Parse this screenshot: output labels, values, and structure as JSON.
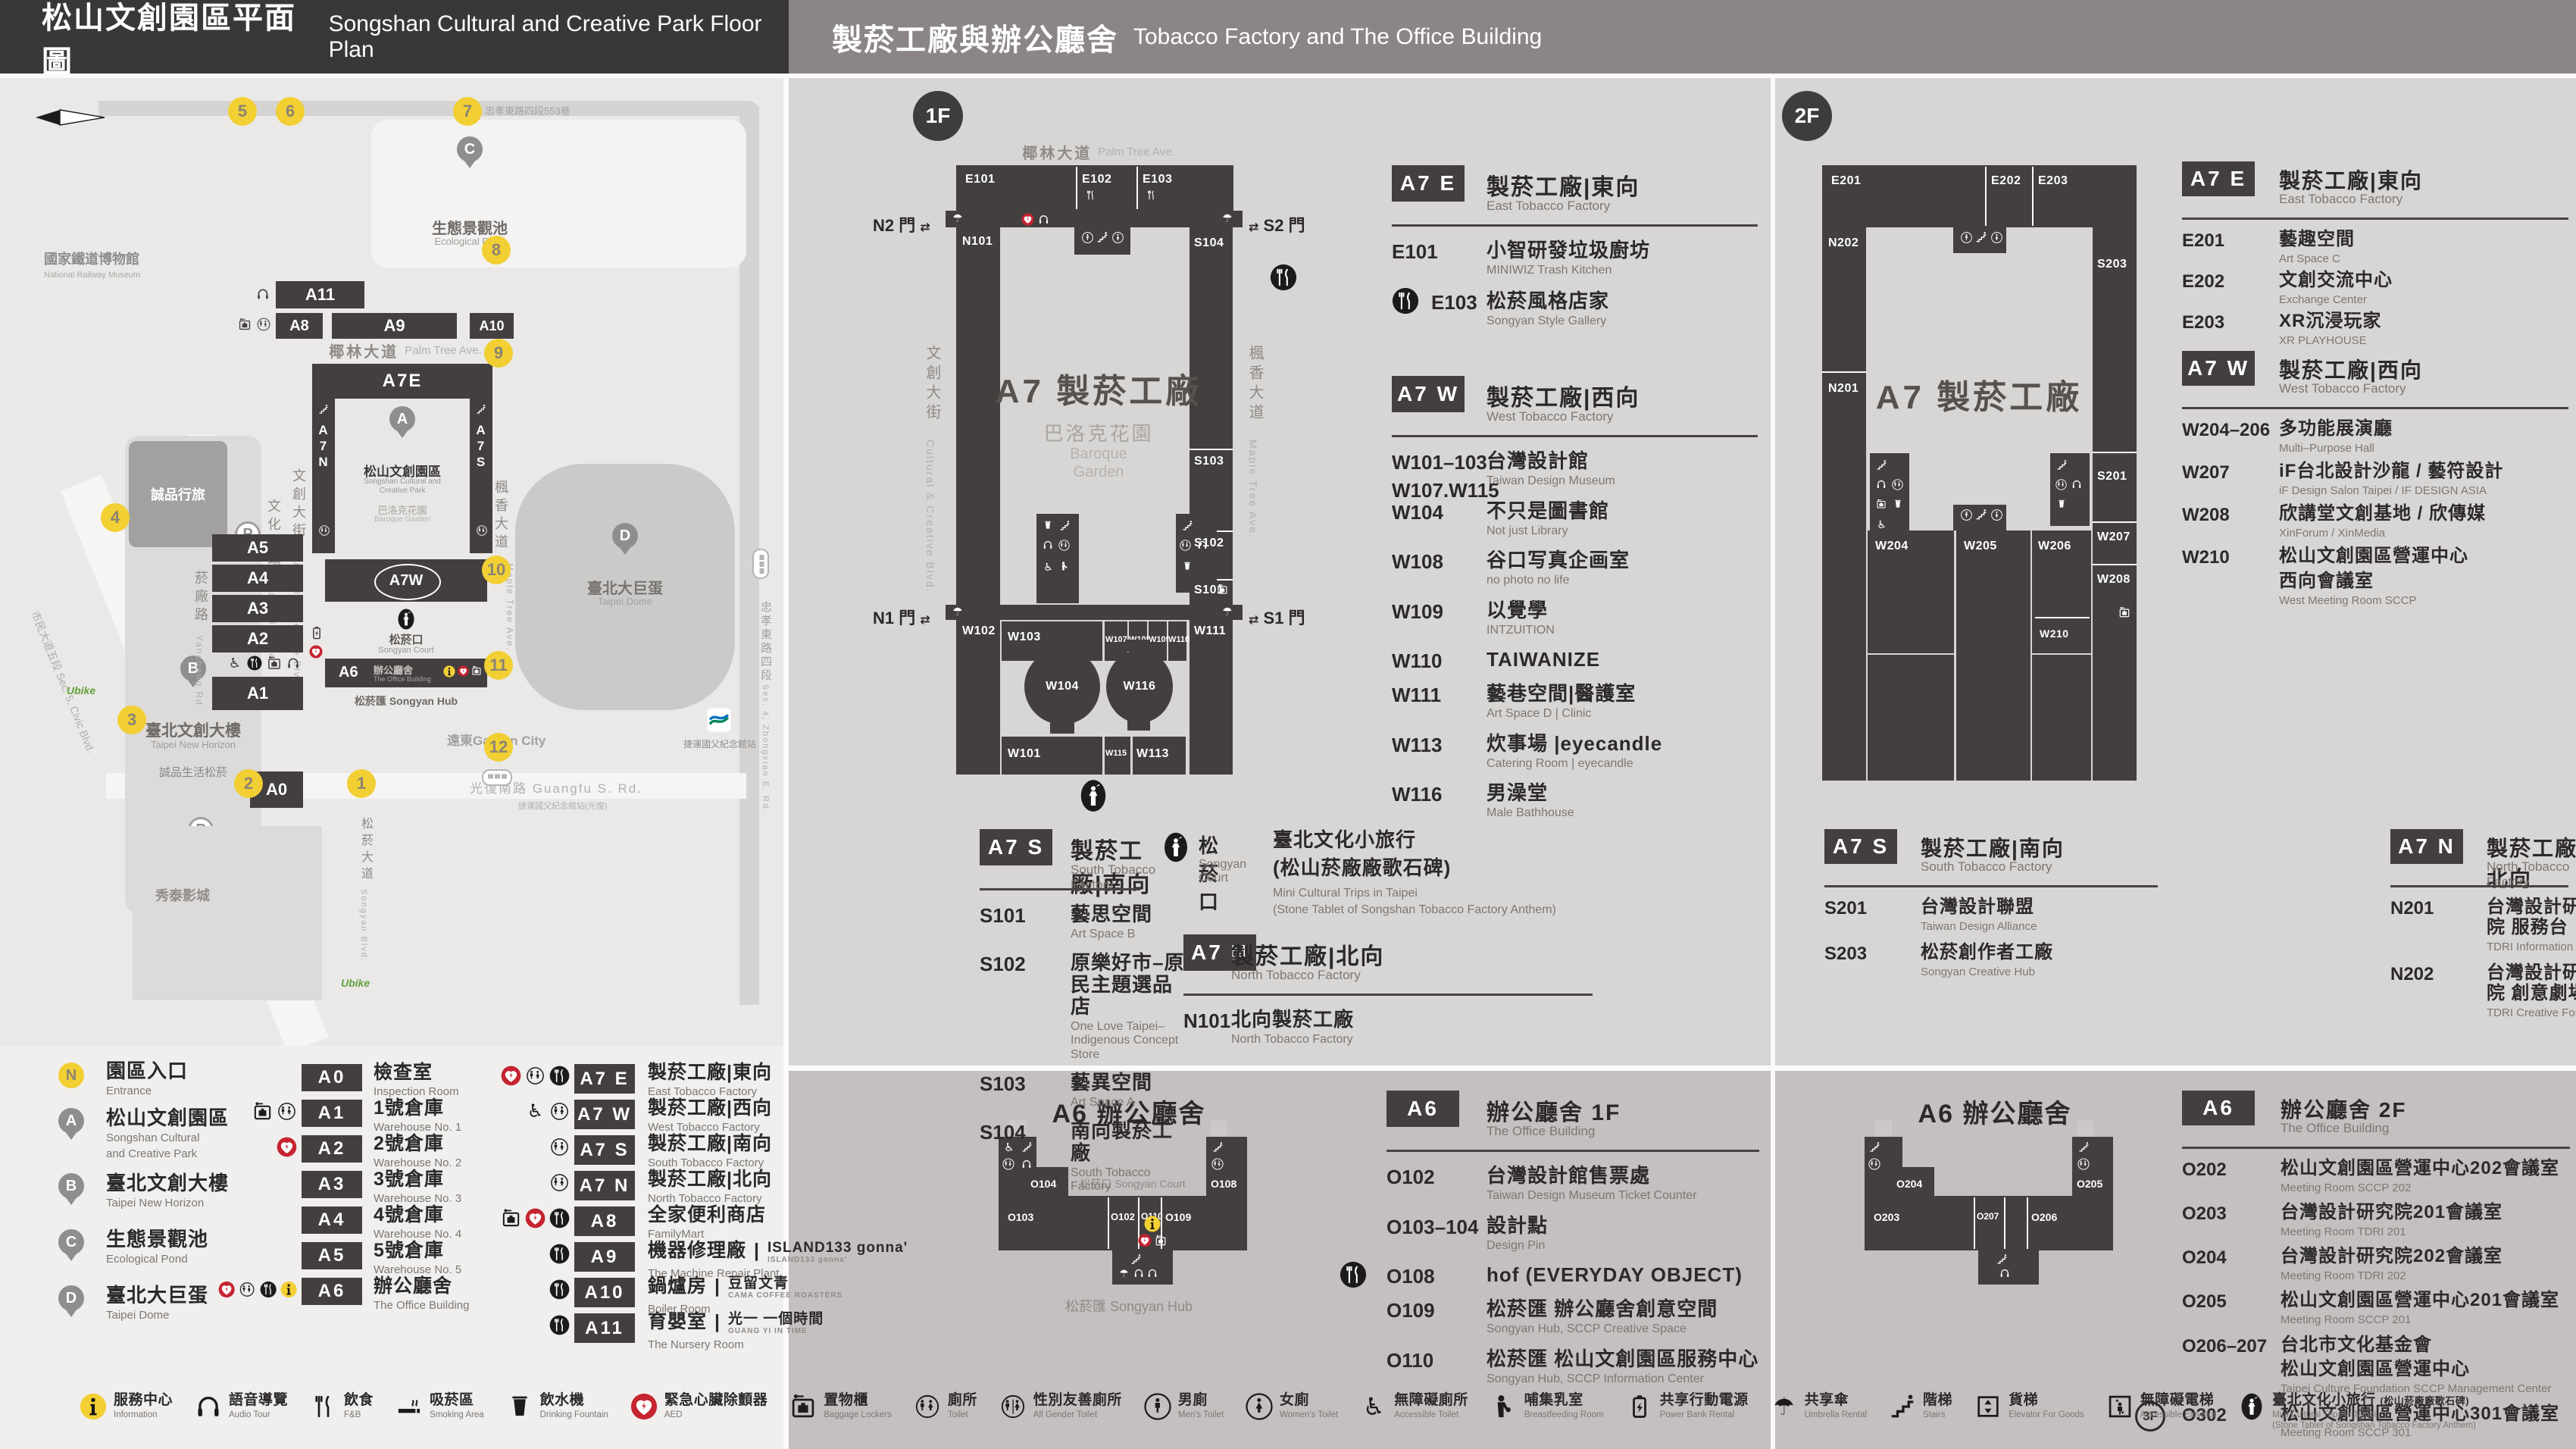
{
  "colors": {
    "accent_yellow": "#f2cf33",
    "aed_red": "#c52430",
    "dark_building": "#433f3f"
  },
  "header": {
    "left_zh": "松山文創園區平面圖",
    "left_en": "Songshan Cultural and Creative Park Floor Plan",
    "right_zh": "製菸工廠與辦公廳舍",
    "right_en": "Tobacco Factory and The Office Building"
  },
  "map": {
    "road_top": "忠孝東路四段553巷",
    "railway_zh": "國家鐵道博物館",
    "railway_en": "National Railway Museum",
    "pond_zh": "生態景觀池",
    "pond_en": "Ecological Pond",
    "palm_zh": "椰林大道",
    "palm_en": "Palm Tree Ave.",
    "eslite_hotel": "誠品行旅",
    "b_zh": "臺北文創大樓",
    "b_en": "Taipei New Horizon",
    "eslite_songyan": "誠品生活松菸",
    "plaza_zh": "文化廣場",
    "plaza_en": "Cultural Plaza",
    "blvd_zh": "文創大街",
    "blvd_en": "Cultural & Creative Blvd.",
    "maple_zh": "楓香大道",
    "maple_en": "Maple Tree Ave.",
    "yanchang_zh": "菸廠路",
    "yanchang_en": "Yanchang Rd.",
    "civic": "市民大道五段 Sec. 5, Civic Blvd.",
    "songyan_ave_zh": "松菸大道",
    "songyan_ave_en": "Songyan Blvd.",
    "zhongxiao_zh": "忠孝東路四段",
    "zhongxiao_en": "Sec. 4, Zhongxiao E. Rd.",
    "guangfu": "光復南路 Guangfu S. Rd.",
    "a7e": "A7E",
    "a7n": "A7N",
    "a7s": "A7S",
    "a7w": "A7W",
    "a6": "A6",
    "park_zh": "松山文創園區",
    "park_en1": "Songshan Cultural and",
    "park_en2": "Creative Park",
    "garden_zh": "巴洛克花園",
    "garden_en": "Baroque Garden",
    "court_zh": "松菸口",
    "court_en": "Songyan Court",
    "office_zh": "辦公廳舍",
    "office_en": "The Office Building",
    "hub": "松菸匯 Songyan Hub",
    "bars": {
      "a11": "A11",
      "a8": "A8",
      "a9": "A9",
      "a10": "A10",
      "a5": "A5",
      "a4": "A4",
      "a3": "A3",
      "a2": "A2",
      "a1": "A1",
      "a0": "A0"
    },
    "dome_zh": "臺北大巨蛋",
    "dome_en": "Taipei Dome",
    "gardencity": "遠東Garden City",
    "showtime": "秀泰影城",
    "mrt": "捷運國父紀念館站",
    "mrt_bus": "捷運國父紀念館站(光復)",
    "ubike": "Ubike",
    "pins": {
      "a": "A",
      "b": "B",
      "c": "C",
      "d": "D"
    },
    "markers": [
      "1",
      "2",
      "3",
      "4",
      "5",
      "6",
      "7",
      "8",
      "9",
      "10",
      "11",
      "12"
    ]
  },
  "plan1f": {
    "badge": "1F",
    "street_top_zh": "椰林大道",
    "street_top_en": "Palm Tree Ave.",
    "street_left_zh": "文創大街",
    "street_left_en": "Cultural & Creative Blvd.",
    "street_right_zh": "楓香大道",
    "street_right_en": "Maple Tree Ave.",
    "center": "A7 製菸工廠",
    "garden_zh": "巴洛克花園",
    "garden_en1": "Baroque",
    "garden_en2": "Garden",
    "gate_n2": "N2 門",
    "gate_s2": "S2 門",
    "gate_n1": "N1 門",
    "gate_s1": "S1 門",
    "rooms": {
      "e101": "E101",
      "e102": "E102",
      "e103": "E103",
      "n101": "N101",
      "w102": "W102",
      "s104": "S104",
      "s103": "S103",
      "s102": "S102",
      "s101": "S101",
      "w111": "W111",
      "w103": "W103",
      "w107": "W107",
      "w108": "W108",
      "w109": "W109",
      "w110": "W110",
      "w104": "W104",
      "w116": "W116",
      "w101": "W101",
      "w115": "W115",
      "w113": "W113"
    }
  },
  "plan2f": {
    "badge": "2F",
    "center": "A7 製菸工廠",
    "rooms": {
      "e201": "E201",
      "e202": "E202",
      "e203": "E203",
      "n202": "N202",
      "n201": "N201",
      "s203": "S203",
      "s201": "S201",
      "w204": "W204",
      "w205": "W205",
      "w206": "W206",
      "w207": "W207",
      "w208": "W208",
      "w210": "W210"
    }
  },
  "a6plan1f": {
    "title": "A6 辦公廳舍",
    "court": "松菸口 Songyan Court",
    "hub": "松菸匯 Songyan Hub",
    "rooms": {
      "o104": "O104",
      "o103": "O103",
      "o102": "O102",
      "o110": "O110",
      "o109": "O109",
      "o108": "O108"
    }
  },
  "a6plan2f": {
    "title": "A6 辦公廳舍",
    "rooms": {
      "o204": "O204",
      "o203": "O203",
      "o207": "O207",
      "o206": "O206",
      "o205": "O205"
    }
  },
  "lists": {
    "f1_e": {
      "badge": "A7 E",
      "zh": "製菸工廠|東向",
      "en": "East Tobacco Factory",
      "rows": [
        {
          "code": "E101",
          "zh": "小智研發垃圾廚坊",
          "en": "MINIWIZ Trash Kitchen"
        },
        {
          "icon": "fnb",
          "code": "E103",
          "zh": "松菸風格店家",
          "en": "Songyan Style Gallery"
        }
      ]
    },
    "f1_w": {
      "badge": "A7 W",
      "zh": "製菸工廠|西向",
      "en": "West Tobacco Factory",
      "rows": [
        {
          "code": "W101–103",
          "code2": "W107.W115",
          "zh": "台灣設計館",
          "en": "Taiwan Design Museum"
        },
        {
          "code": "W104",
          "zh": "不只是圖書館",
          "en": "Not just Library"
        },
        {
          "code": "W108",
          "zh": "谷口写真企画室",
          "en": "no photo no life"
        },
        {
          "code": "W109",
          "zh": "以覺學",
          "en": "INTZUITION"
        },
        {
          "code": "W110",
          "zh": "TAIWANIZE"
        },
        {
          "code": "W111",
          "zh": "藝巷空間|醫護室",
          "en": "Art Space D | Clinic"
        },
        {
          "code": "W113",
          "zh": "炊事場 |eyecandle",
          "en": "Catering Room | eyecandle"
        },
        {
          "code": "W116",
          "zh": "男澡堂",
          "en": "Male Bathhouse"
        }
      ]
    },
    "f1_s": {
      "badge": "A7 S",
      "zh": "製菸工廠|南向",
      "en": "South Tobacco Factory",
      "rows": [
        {
          "code": "S101",
          "zh": "藝思空間",
          "en": "Art Space B"
        },
        {
          "code": "S102",
          "zh": "原樂好市–原民主題選品店",
          "en": "One Love Taipei–Indigenous Concept Store"
        },
        {
          "code": "S103",
          "zh": "藝異空間",
          "en": "Art Space A"
        },
        {
          "code": "S104",
          "zh": "南向製菸工廠",
          "en": "South Tobacco Factory"
        }
      ]
    },
    "f1_n": {
      "badge": "A7 N",
      "zh": "製菸工廠|北向",
      "en": "North Tobacco Factory",
      "rows": [
        {
          "code": "N101",
          "zh": "北向製菸工廠",
          "en": "North Tobacco Factory"
        }
      ]
    },
    "f2_e": {
      "badge": "A7 E",
      "zh": "製菸工廠|東向",
      "en": "East Tobacco Factory",
      "rows": [
        {
          "code": "E201",
          "zh": "藝趣空間",
          "en": "Art Space C"
        },
        {
          "code": "E202",
          "zh": "文創交流中心",
          "en": "Exchange Center"
        },
        {
          "code": "E203",
          "zh": "XR沉浸玩家",
          "en": "XR PLAYHOUSE"
        }
      ]
    },
    "f2_w": {
      "badge": "A7 W",
      "zh": "製菸工廠|西向",
      "en": "West Tobacco Factory",
      "rows": [
        {
          "code": "W204–206",
          "zh": "多功能展演廳",
          "en": "Multi–Purpose Hall"
        },
        {
          "code": "W207",
          "zh": "iF台北設計沙龍 / 藝符設計",
          "en": "iF Design Salon Taipei / IF DESIGN ASIA"
        },
        {
          "code": "W208",
          "zh": "欣講堂文創基地 / 欣傳媒",
          "en": "XinForum / XinMedia"
        },
        {
          "code": "W210",
          "zh": "松山文創園區營運中心",
          "zh2": "西向會議室",
          "en": "West Meeting Room SCCP"
        }
      ]
    },
    "f2_s": {
      "badge": "A7 S",
      "zh": "製菸工廠|南向",
      "en": "South Tobacco Factory",
      "rows": [
        {
          "code": "S201",
          "zh": "台灣設計聯盟",
          "en": "Taiwan Design Alliance"
        },
        {
          "code": "S203",
          "zh": "松菸創作者工廠",
          "en": "Songyan Creative Hub"
        }
      ]
    },
    "f2_n": {
      "badge": "A7 N",
      "zh": "製菸工廠|北向",
      "en": "North Tobacco Factory",
      "rows": [
        {
          "code": "N201",
          "zh": "台灣設計研究院 服務台",
          "en": "TDRI Information"
        },
        {
          "code": "N202",
          "zh": "台灣設計研究院 創意劇場",
          "en": "TDRI Creative Forum"
        }
      ]
    },
    "a6_1f": {
      "badge": "A6",
      "zh": "辦公廳舍 1F",
      "en": "The Office Building",
      "rows": [
        {
          "code": "O102",
          "zh": "台灣設計館售票處",
          "en": "Taiwan Design Museum Ticket Counter"
        },
        {
          "code": "O103–104",
          "zh": "設計點",
          "en": "Design Pin"
        },
        {
          "icon": "fnb",
          "code": "O108",
          "zh": "hof (EVERYDAY OBJECT)"
        },
        {
          "code": "O109",
          "zh": "松菸匯 辦公廳舍創意空間",
          "en": "Songyan Hub, SCCP Creative Space"
        },
        {
          "code": "O110",
          "zh": "松菸匯 松山文創園區服務中心",
          "en": "Songyan Hub, SCCP Information Center"
        }
      ]
    },
    "a6_2f": {
      "badge": "A6",
      "zh": "辦公廳舍 2F",
      "en": "The Office Building",
      "rows": [
        {
          "code": "O202",
          "zh": "松山文創園區營運中心202會議室",
          "en": "Meeting Room SCCP 202"
        },
        {
          "code": "O203",
          "zh": "台灣設計研究院201會議室",
          "en": "Meeting Room TDRI 201"
        },
        {
          "code": "O204",
          "zh": "台灣設計研究院202會議室",
          "en": "Meeting Room TDRI 202"
        },
        {
          "code": "O205",
          "zh": "松山文創園區營運中心201會議室",
          "en": "Meeting Room SCCP 201"
        },
        {
          "code": "O206–207",
          "zh": "台北市文化基金會",
          "zh2": "松山文創園區營運中心",
          "en": "Taipei Culture Foundation SCCP Management Center"
        },
        {
          "icon": "threef",
          "code": "O302",
          "zh": "松山文創園區營運中心301會議室",
          "en": "Meeting Room SCCP 301"
        }
      ]
    }
  },
  "court": {
    "zh": "松菸口",
    "en": "Songyan Court",
    "name_zh1": "臺北文化小旅行",
    "name_zh2": "(松山菸廠廠歌石碑)",
    "name_en1": "Mini Cultural Trips in Taipei",
    "name_en2": "(Stone Tablet of Songshan Tobacco Factory Anthem)"
  },
  "legend_places": [
    {
      "mark": "N",
      "type": "circle",
      "zh": "園區入口",
      "en": [
        "Entrance"
      ]
    },
    {
      "mark": "A",
      "type": "pin",
      "zh": "松山文創園區",
      "en": [
        "Songshan Cultural",
        "and Creative Park"
      ]
    },
    {
      "mark": "B",
      "type": "pin",
      "zh": "臺北文創大樓",
      "en": [
        "Taipei New Horizon"
      ]
    },
    {
      "mark": "C",
      "type": "pin",
      "zh": "生態景觀池",
      "en": [
        "Ecological Pond"
      ]
    },
    {
      "mark": "D",
      "type": "pin",
      "zh": "臺北大巨蛋",
      "en": [
        "Taipei Dome"
      ]
    }
  ],
  "legend_mid": [
    {
      "icons": [],
      "badge": "A0",
      "zh": "檢查室",
      "en": "Inspection Room"
    },
    {
      "icons": [
        "lockers",
        "toilet"
      ],
      "badge": "A1",
      "zh": "1號倉庫",
      "en": "Warehouse No. 1"
    },
    {
      "icons": [
        "aed"
      ],
      "badge": "A2",
      "zh": "2號倉庫",
      "en": "Warehouse No. 2"
    },
    {
      "icons": [],
      "badge": "A3",
      "zh": "3號倉庫",
      "en": "Warehouse No. 3"
    },
    {
      "icons": [],
      "badge": "A4",
      "zh": "4號倉庫",
      "en": "Warehouse No. 4"
    },
    {
      "icons": [],
      "badge": "A5",
      "zh": "5號倉庫",
      "en": "Warehouse No. 5"
    },
    {
      "icons": [
        "aed",
        "toilet",
        "fnb",
        "info"
      ],
      "badge": "A6",
      "zh": "辦公廳舍",
      "en": "The Office Building"
    }
  ],
  "legend_right": [
    {
      "icons": [
        "aed",
        "toilet",
        "fnb"
      ],
      "badge": "A7 E",
      "zh": "製菸工廠|東向",
      "en": "East Tobacco Factory"
    },
    {
      "icons": [
        "accessible",
        "toilet"
      ],
      "badge": "A7 W",
      "zh": "製菸工廠|西向",
      "en": "West Tobacco Factory"
    },
    {
      "icons": [
        "toilet"
      ],
      "badge": "A7 S",
      "zh": "製菸工廠|南向",
      "en": "South Tobacco Factory"
    },
    {
      "icons": [
        "toilet"
      ],
      "badge": "A7 N",
      "zh": "製菸工廠|北向",
      "en": "North Tobacco Factory"
    },
    {
      "icons": [
        "lockers",
        "aed",
        "fnb"
      ],
      "badge": "A8",
      "zh": "全家便利商店",
      "en": "FamilyMart"
    },
    {
      "icons": [
        "fnb"
      ],
      "badge": "A9",
      "zh": "機器修理廠",
      "brand": "ISLAND133 gonna'",
      "brand_en": "ISLAND133 gonna'",
      "en": "The Machine Repair Plant"
    },
    {
      "icons": [
        "fnb"
      ],
      "badge": "A10",
      "zh": "鍋爐房",
      "brand": "豆留文青",
      "brand_en": "CAMA COFFEE ROASTERS",
      "en": "Boiler Room"
    },
    {
      "icons": [
        "fnb"
      ],
      "badge": "A11",
      "zh": "育嬰室",
      "brand": "光一 一個時間",
      "brand_en": "GUANG YI IN TIME",
      "en": "The Nursery Room"
    }
  ],
  "footer": [
    {
      "icon": "info",
      "zh": "服務中心",
      "en": "Information"
    },
    {
      "icon": "audio",
      "zh": "語音導覽",
      "en": "Audio Tour"
    },
    {
      "icon": "fnbline",
      "zh": "飲食",
      "en": "F&B"
    },
    {
      "icon": "smoking",
      "zh": "吸菸區",
      "en": "Smoking Area"
    },
    {
      "icon": "drinking",
      "zh": "飲水機",
      "en": "Drinking Fountain"
    },
    {
      "icon": "aed",
      "zh": "緊急心臟除顫器",
      "en": "AED"
    },
    {
      "icon": "lockers",
      "zh": "置物櫃",
      "en": "Baggage Lockers"
    },
    {
      "icon": "toilet",
      "zh": "廁所",
      "en": "Toilet"
    },
    {
      "icon": "allgender",
      "zh": "性別友善廁所",
      "en": "All Gender Toilet"
    },
    {
      "icon": "men",
      "zh": "男廁",
      "en": "Men's Toilet"
    },
    {
      "icon": "women",
      "zh": "女廁",
      "en": "Women's Toilet"
    },
    {
      "icon": "accessible",
      "zh": "無障礙廁所",
      "en": "Accessible Toilet"
    },
    {
      "icon": "breastfeeding",
      "zh": "哺集乳室",
      "en": "Breastfeeding Room"
    },
    {
      "icon": "powerbank",
      "zh": "共享行動電源",
      "en": "Power Bank Rental"
    },
    {
      "icon": "umbrella",
      "zh": "共享傘",
      "en": "Umbrella Rental"
    },
    {
      "icon": "stairs",
      "zh": "階梯",
      "en": "Stairs"
    },
    {
      "icon": "goods",
      "zh": "貨梯",
      "en": "Elevator For Goods"
    },
    {
      "icon": "accelevator",
      "zh": "無障礙電梯",
      "en": "Accessible Elevator"
    },
    {
      "icon": "trip",
      "zh": "臺北文化小旅行",
      "zh2": "(松山菸廠廠歌石碑)",
      "en": "Mini Cultural Trips in Taipei",
      "en2": "(Stone Tablet of Songshan Tobacco Factory Anthem)"
    }
  ]
}
